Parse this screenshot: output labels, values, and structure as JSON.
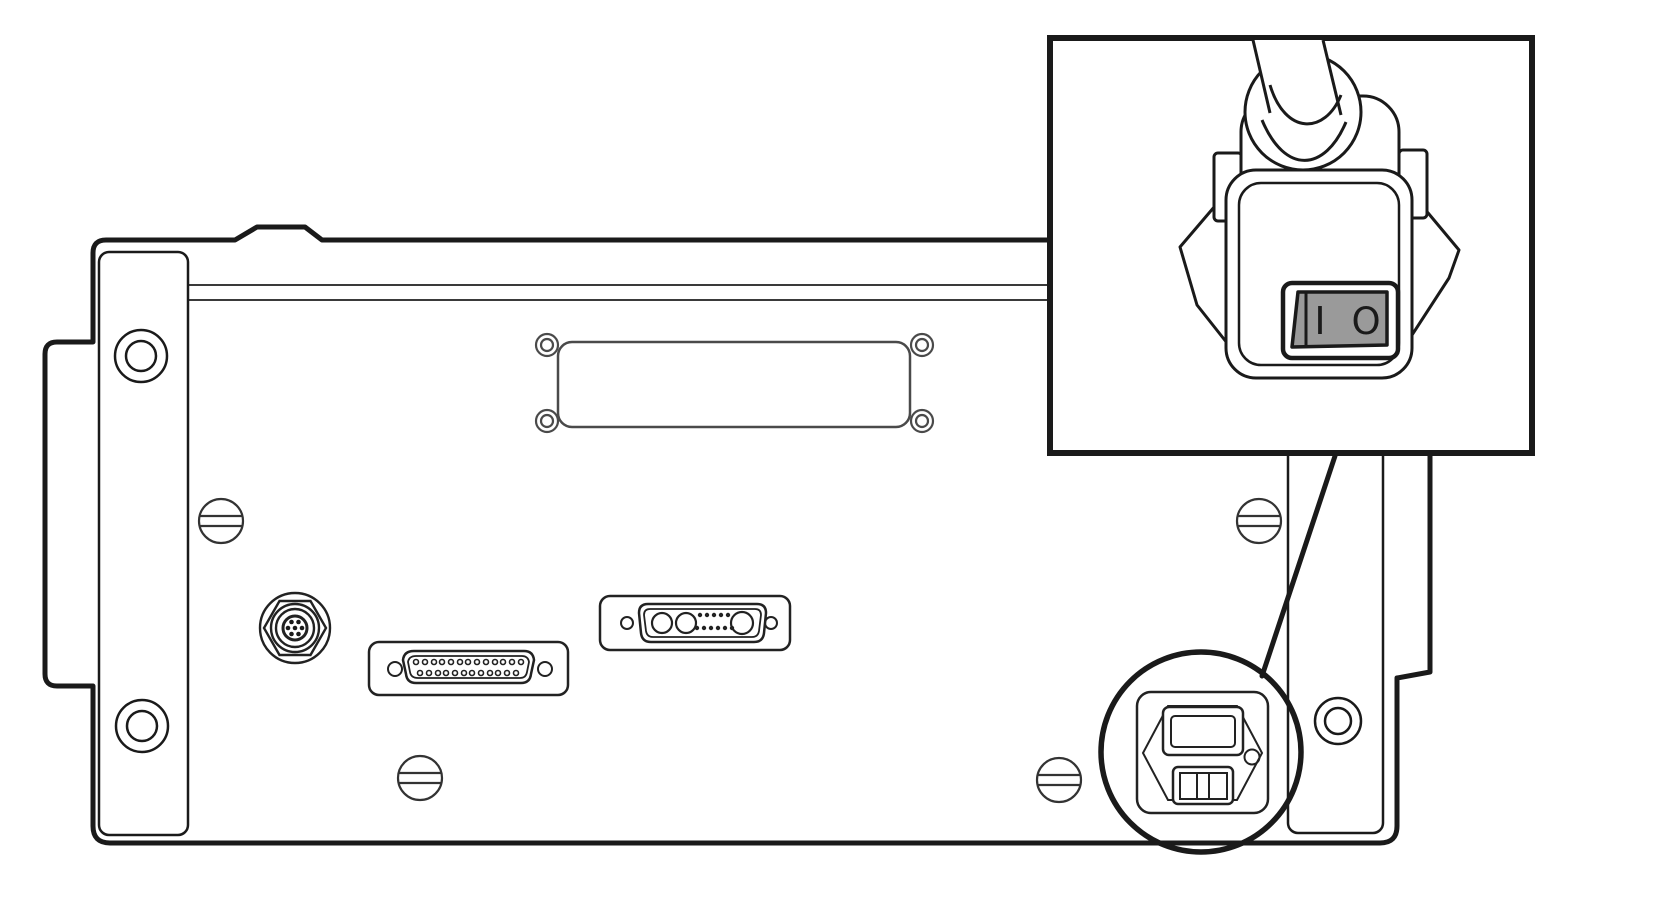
{
  "figure": {
    "kind": "technical-line-diagram",
    "subject": "instrument-rear-panel-with-power-inlet-callout",
    "canvas": {
      "width": 1665,
      "height": 910
    },
    "colors": {
      "background": "#ffffff",
      "outline": "#1a1a1a",
      "secondary_line": "#3a3a3a",
      "plate_line": "#4a4a4a",
      "rocker_fill": "#9a9a9a"
    }
  },
  "rear_panel": {
    "left_bracket": {
      "holes": 2
    },
    "right_bracket": {
      "holes_visible": 1
    },
    "blank_cover_plate": {
      "corner_screws": 4
    },
    "slotted_screws": 4,
    "circular_connector": {
      "center_pins": 7
    },
    "db25_connector": {
      "top_row_pins": 13,
      "bottom_row_pins": 12
    },
    "combo_dsub_connector": {
      "large_sockets": 3,
      "small_pins_top": 5,
      "small_pins_bottom": 6
    },
    "power_inlet_module": {
      "elements": [
        "iec-socket",
        "fuse-drawer-switch",
        "round-hole"
      ],
      "circled": true
    }
  },
  "callout": {
    "shows": "power-cord-plug-with-rocker-switch",
    "power_switch": {
      "on_label": "I",
      "off_label": "O",
      "rocker_fill_color": "#9a9a9a"
    }
  }
}
